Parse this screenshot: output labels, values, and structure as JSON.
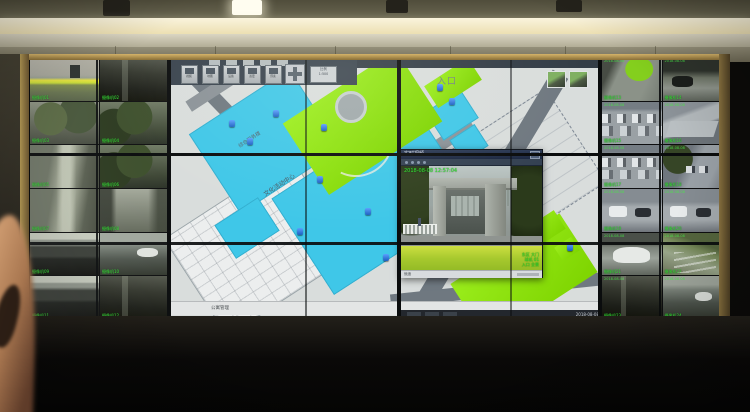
{
  "scene": {
    "description": "Surveillance control-room video wall: side monitors show CCTV camera grids, center monitors show a campus GIS map application with a live-video popup window; an arm is silhouetted at lower left."
  },
  "popup": {
    "title": "实时视频",
    "close": "×",
    "timestamp": "2018-08-08 12:57:04",
    "overlay_lines": [
      "东区 大门",
      "球机 01",
      "入口 全景"
    ],
    "status_left": "就绪",
    "colors": {
      "titlebar": "#22304a",
      "overlay_green": "#2ee62e"
    }
  },
  "map": {
    "toolbar": [
      {
        "label": "视频"
      },
      {
        "label": "地图"
      },
      {
        "label": "设备"
      },
      {
        "label": "巡更"
      },
      {
        "label": "预案"
      }
    ],
    "scale_box": [
      "比例",
      "1:500"
    ],
    "labels": {
      "entrance": "入口",
      "center": "文化活动中心",
      "building": "综合服务楼"
    },
    "status_text": "公寓管理",
    "tray_text": "2018-08-08",
    "colors": {
      "building_cyan": "#3fc7e8",
      "lawn_green": "#8ee310",
      "road_gray": "#6f7880"
    }
  },
  "feeds": {
    "timestamp": "2018-08-08",
    "left": [
      {
        "label": "摄像机01",
        "scene": "gate"
      },
      {
        "label": "摄像机02",
        "scene": "dark"
      },
      {
        "label": "摄像机03",
        "scene": "court"
      },
      {
        "label": "摄像机04",
        "scene": "trees"
      },
      {
        "label": "摄像机05",
        "scene": "path"
      },
      {
        "label": "摄像机06",
        "scene": "trees"
      },
      {
        "label": "摄像机07",
        "scene": "path"
      },
      {
        "label": "摄像机08",
        "scene": "road"
      },
      {
        "label": "摄像机09",
        "scene": "garage"
      },
      {
        "label": "摄像机10",
        "scene": "alleycar"
      },
      {
        "label": "摄像机11",
        "scene": "garage"
      },
      {
        "label": "摄像机12",
        "scene": "dark"
      }
    ],
    "right": [
      {
        "label": "摄像机13",
        "scene": "streetlawn"
      },
      {
        "label": "摄像机14",
        "scene": "canopy"
      },
      {
        "label": "摄像机15",
        "scene": "parking"
      },
      {
        "label": "摄像机16",
        "scene": "awning"
      },
      {
        "label": "摄像机17",
        "scene": "parking"
      },
      {
        "label": "摄像机18",
        "scene": "streettrees"
      },
      {
        "label": "摄像机19",
        "scene": "vans"
      },
      {
        "label": "摄像机20",
        "scene": "vans"
      },
      {
        "label": "摄像机21",
        "scene": "carclose"
      },
      {
        "label": "摄像机22",
        "scene": "stairs"
      },
      {
        "label": "摄像机23",
        "scene": "dark"
      },
      {
        "label": "摄像机24",
        "scene": "alleycar"
      }
    ]
  }
}
